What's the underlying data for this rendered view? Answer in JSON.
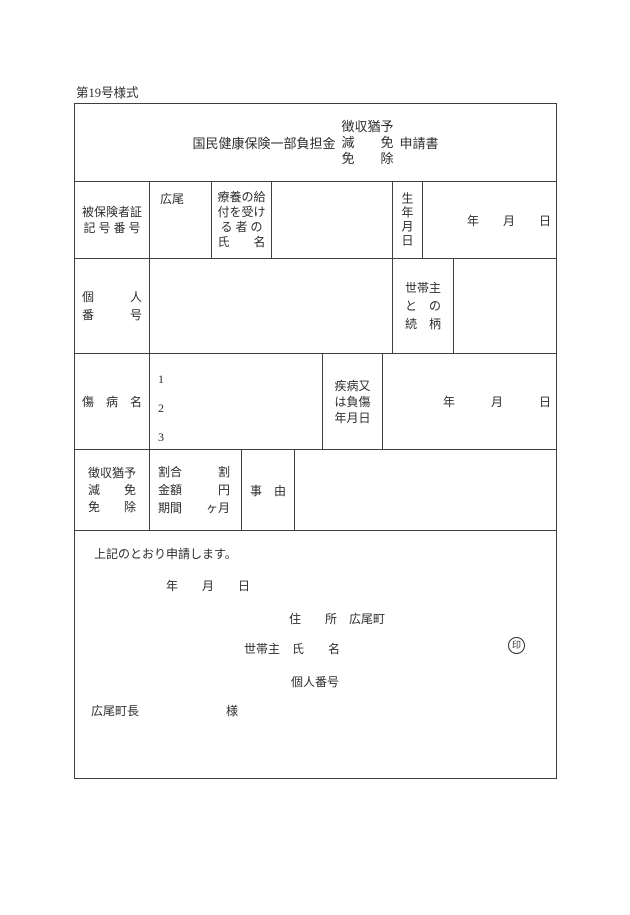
{
  "form_number": "第19号様式",
  "title": {
    "main": "国民健康保険一部負担金",
    "stack": "徴収猶予\n減　　免\n免　　除",
    "suffix": "申請書"
  },
  "insured_row": {
    "label": "被保険者証\n記 号 番 号",
    "symbol_value": "広尾",
    "recipient_label": "療養の給\n付を受け\nる 者 の\n氏　　名",
    "birthdate_label": "生年月日",
    "birthdate_value": "年　　月　　日"
  },
  "personal_number_row": {
    "label": "個　　　人\n番　　　号",
    "relationship_label": "世帯主\nと　の\n続　柄"
  },
  "disease_row": {
    "label": "傷　病　名",
    "numbers": "1\n2\n3",
    "onset_label": "疾病又\nは負傷\n年月日",
    "onset_value": "年　　　月　　　日"
  },
  "deferral_row": {
    "label": "徴収猶予\n減　　免\n免　　除",
    "terms_label": "割合　　　割\n金額　　　円\n期間　　ヶ月",
    "reason_label": "事　由"
  },
  "footer": {
    "declaration": "上記のとおり申請します。",
    "date_line": "年　　月　　日",
    "address_label": "住　　所",
    "address_value": "広尾町",
    "householder_line": "世帯主　氏　　名",
    "seal_char": "印",
    "personal_number_label": "個人番号",
    "mayor_label": "広尾町長",
    "honorific": "様"
  },
  "colors": {
    "text": "#2d2d2d",
    "border": "#3f3f3f",
    "background": "#ffffff"
  }
}
